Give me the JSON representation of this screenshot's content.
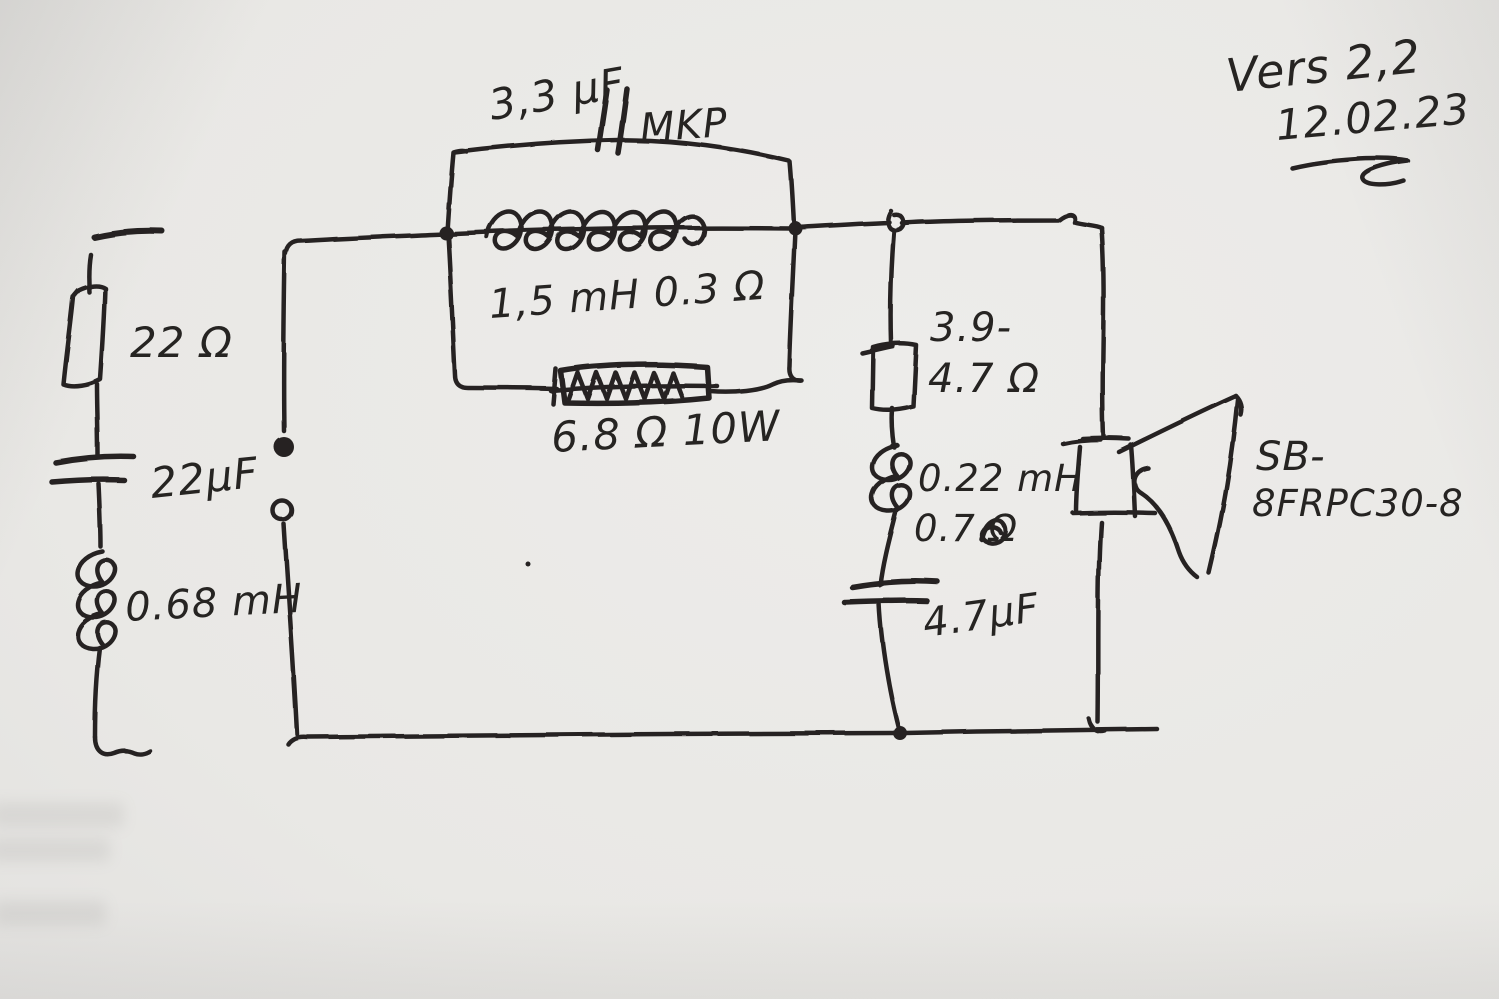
{
  "colors": {
    "ink": "#262422",
    "paper": "#e9e8e5"
  },
  "title_block": {
    "version": "Vers 2,2",
    "date": "12.02.23"
  },
  "crossover": {
    "input_notch": {
      "resistor": "22 Ω",
      "capacitor": "22µF",
      "inductor": "0.68 mH"
    },
    "series_cell": {
      "bypass_capacitor": "3,3 µF",
      "capacitor_type": "MKP",
      "inductor": "1,5 mH 0.3 Ω",
      "damping_resistor": "6.8 Ω 10W"
    },
    "shunt_branch": {
      "resistor_line1": "3.9-",
      "resistor_line2": "4.7 Ω",
      "inductor": "0.22 mH",
      "inductor_dcr": "0.7 Ω",
      "capacitor": "4.7µF"
    },
    "driver": {
      "name_line1": "SB-",
      "name_line2": "8FRPC30-8"
    }
  }
}
